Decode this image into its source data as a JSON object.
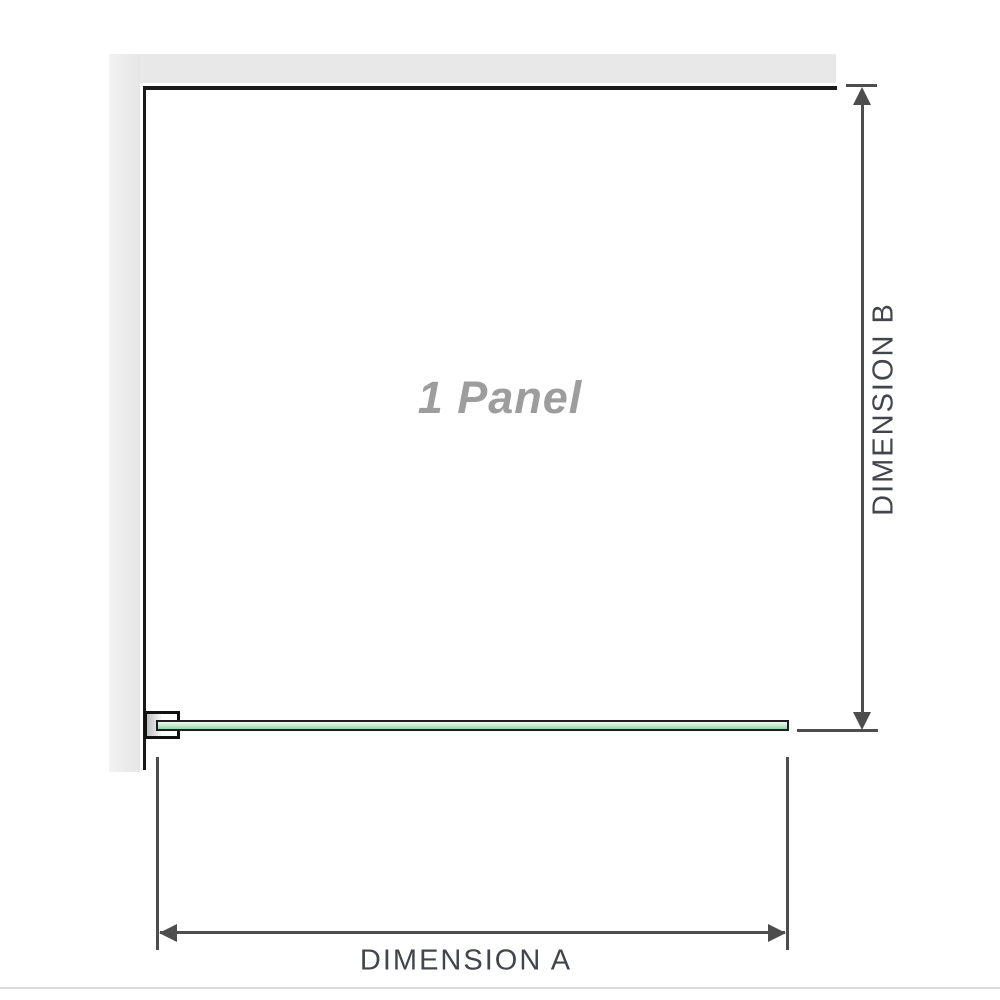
{
  "diagram": {
    "title": "1 Panel shower screen dimension diagram",
    "panel_label": "1 Panel",
    "dimension_a_label": "DIMENSION A",
    "dimension_b_label": "DIMENSION B"
  },
  "colors": {
    "wall_fill": "#e8e8e8",
    "wall_edge": "#1a1a1a",
    "glass_green": "#93d2a5",
    "glass_highlight": "#f0faf3",
    "glass_border": "#1e1e1e",
    "bracket_border": "#111111",
    "dimension_line": "#4d4d4d",
    "dimension_label": "#42454d",
    "panel_label_gray": "#9d9d9d",
    "baseline_gray": "#dedad3"
  }
}
